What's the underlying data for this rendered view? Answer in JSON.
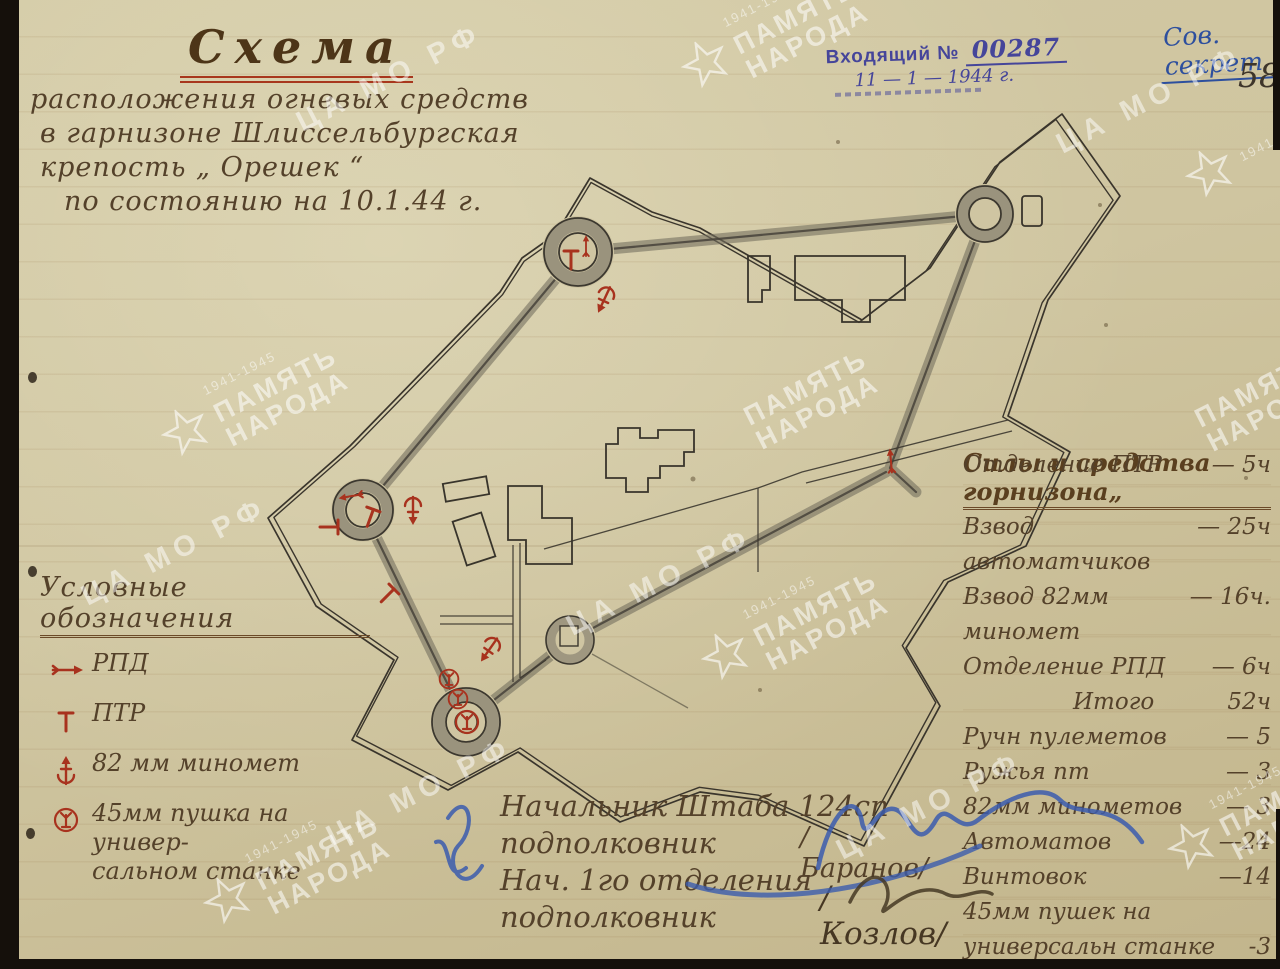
{
  "colors": {
    "paper": "#cfc5a2",
    "ink_brown": "#54412a",
    "ink_red": "#a8321e",
    "ink_blue": "#3b5cae",
    "pencil": "#46423a",
    "stamp_purple": "#45459a",
    "title_underline_red": "#a8371d"
  },
  "classification": "Сов. секрет",
  "page_number": "58",
  "stamp": {
    "label": "Входящий №",
    "number": "00287",
    "date": "11 — 1 — 1944 г."
  },
  "title": {
    "heading": "Схема",
    "line1": "расположения огневых средств",
    "line2": "в гарнизоне Шлиссельбургская",
    "line3": "крепость „ Орешек “",
    "line4": "по состоянию на 10.1.44 г."
  },
  "legend": {
    "title": "Условные обозначения",
    "items": [
      {
        "symbol": "rpd",
        "lines": [
          "РПД"
        ]
      },
      {
        "symbol": "ptr",
        "lines": [
          "ПТР"
        ]
      },
      {
        "symbol": "mortar",
        "lines": [
          "82 мм миномет"
        ]
      },
      {
        "symbol": "gun45",
        "lines": [
          "45мм пушка  на универ-",
          "сальном станке"
        ]
      }
    ]
  },
  "forces": {
    "title": "Силы и средства горнизона„",
    "rows": [
      {
        "label": "Взвод автоматчиков",
        "value": "— 25ч"
      },
      {
        "label": "Взвод 82мм миномет",
        "value": "— 16ч."
      },
      {
        "label": "Отделение РПД",
        "value": "— 6ч"
      },
      {
        "label": "Отделение ПТР",
        "value": "— 5ч",
        "rule_below": true
      },
      {
        "label": "Итого",
        "value": "52ч",
        "indent": true
      },
      {
        "label": "Ручн пулеметов",
        "value": "— 5"
      },
      {
        "label": "Ружья пт",
        "value": "— 3"
      },
      {
        "label": "82мм минометов",
        "value": "— 3"
      },
      {
        "label": "Автоматов",
        "value": "—24"
      },
      {
        "label": "Винтовок",
        "value": "—14"
      },
      {
        "label": "45мм пушек на",
        "value": ""
      },
      {
        "label": "универсальн станке",
        "value": "-3"
      }
    ]
  },
  "signatures": {
    "role1": "Начальник Штаба 124сп",
    "rank1": "подполковник",
    "name1": "/Баранов/",
    "role2": "Нач. 1го отделения",
    "rank2": "подполковник",
    "name2": "/Козлов/"
  },
  "watermarks": {
    "memory_line1": "ПАМЯТЬ",
    "memory_line2": "НАРОДА",
    "years": "1941-1945",
    "archive": "ЦА МО РФ",
    "instances": [
      {
        "kind": "memory",
        "x": 770,
        "y": 30,
        "star": true,
        "years": true
      },
      {
        "kind": "archive",
        "x": 390,
        "y": 78
      },
      {
        "kind": "archive",
        "x": 1150,
        "y": 100
      },
      {
        "kind": "memory",
        "x": 250,
        "y": 398,
        "star": true,
        "years": true
      },
      {
        "kind": "memory",
        "x": 812,
        "y": 400,
        "star": false,
        "years": false
      },
      {
        "kind": "star",
        "x": 1250,
        "y": 152
      },
      {
        "kind": "memory",
        "x": 790,
        "y": 622,
        "star": true,
        "years": true
      },
      {
        "kind": "archive",
        "x": 660,
        "y": 582
      },
      {
        "kind": "memory",
        "x": 1263,
        "y": 402,
        "star": false,
        "years": false
      },
      {
        "kind": "archive",
        "x": 175,
        "y": 552
      },
      {
        "kind": "archive",
        "x": 420,
        "y": 792
      },
      {
        "kind": "archive",
        "x": 930,
        "y": 806
      },
      {
        "kind": "memory",
        "x": 292,
        "y": 866,
        "star": true,
        "years": true
      },
      {
        "kind": "memory",
        "x": 1256,
        "y": 812,
        "star": true,
        "years": true
      }
    ]
  },
  "map": {
    "symbols": [
      {
        "type": "ptr",
        "x": 571,
        "y": 258,
        "rot": 0
      },
      {
        "type": "rpd",
        "x": 586,
        "y": 247,
        "rot": -90,
        "scale": 0.7
      },
      {
        "type": "mortar",
        "x": 604,
        "y": 300,
        "rot": 205
      },
      {
        "type": "rpd",
        "x": 891,
        "y": 462,
        "rot": -95,
        "scale": 0.8
      },
      {
        "type": "rpd",
        "x": 352,
        "y": 496,
        "rot": 170,
        "scale": 0.8
      },
      {
        "type": "ptr",
        "x": 371,
        "y": 516,
        "rot": 20
      },
      {
        "type": "ptr",
        "x": 331,
        "y": 527,
        "rot": 90
      },
      {
        "type": "mortar",
        "x": 413,
        "y": 511,
        "rot": 180
      },
      {
        "type": "ptr",
        "x": 389,
        "y": 594,
        "rot": 45
      },
      {
        "type": "mortar",
        "x": 489,
        "y": 650,
        "rot": 215
      },
      {
        "type": "gun45",
        "x": 449,
        "y": 679,
        "rot": 0,
        "scale": 0.85
      },
      {
        "type": "gun45",
        "x": 458,
        "y": 699,
        "rot": 0,
        "scale": 0.85
      },
      {
        "type": "gun45",
        "x": 467,
        "y": 722,
        "rot": 0
      }
    ]
  }
}
